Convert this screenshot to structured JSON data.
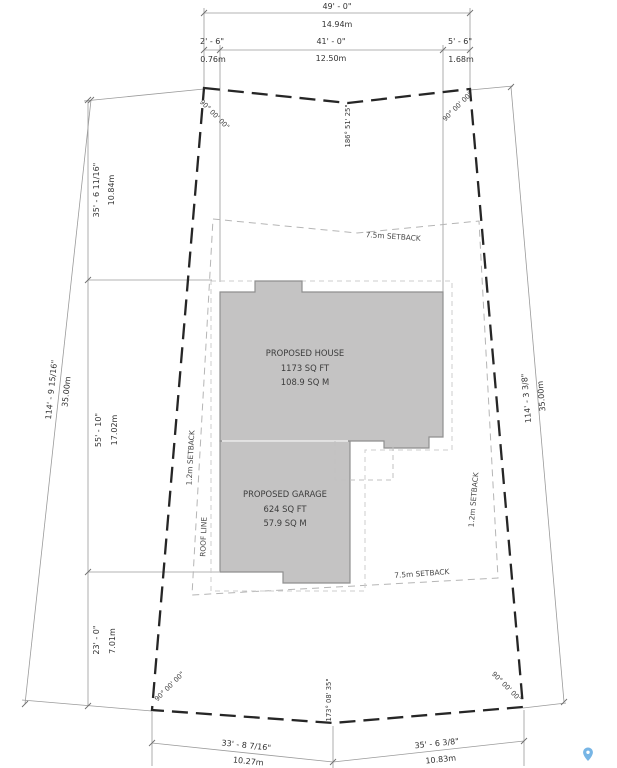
{
  "colors": {
    "lot_boundary": "#262626",
    "building_fill": "#c4c3c3",
    "building_stroke": "#8f8f8f",
    "dimension_line": "#9a9a9a",
    "setback_line": "#b5b5b5",
    "roof_line_dash": "#cccccc",
    "text": "#333333",
    "pin_blue": "#77b5e5"
  },
  "labels": {
    "house": {
      "name": "PROPOSED HOUSE",
      "area_ft": "1173 SQ FT",
      "area_m": "108.9 SQ M"
    },
    "garage": {
      "name": "PROPOSED GARAGE",
      "area_ft": "624 SQ FT",
      "area_m": "57.9 SQ M"
    },
    "setback_front": "7.5m SETBACK",
    "setback_rear": "7.5m SETBACK",
    "setback_left": "1.2m SETBACK",
    "setback_right": "1.2m SETBACK",
    "roof_line": "ROOF LINE"
  },
  "dimensions": {
    "top": {
      "overall_ft": "49' - 0\"",
      "overall_m": "14.94m",
      "seg_left_ft": "2' - 6\"",
      "seg_left_m": "0.76m",
      "seg_mid_ft": "41' - 0\"",
      "seg_mid_m": "12.50m",
      "seg_right_ft": "5' - 6\"",
      "seg_right_m": "1.68m"
    },
    "left": {
      "overall_ft": "114' - 9 15/16\"",
      "overall_m": "35.00m",
      "seg_upper_ft": "35' - 6 11/16\"",
      "seg_upper_m": "10.84m",
      "seg_mid_ft": "55' - 10\"",
      "seg_mid_m": "17.02m",
      "seg_lower_ft": "23' - 0\"",
      "seg_lower_m": "7.01m"
    },
    "right": {
      "overall_ft": "114' - 3 3/8\"",
      "overall_m": "35.00m"
    },
    "bottom": {
      "seg_left_ft": "33' - 8 7/16\"",
      "seg_left_m": "10.27m",
      "seg_right_ft": "35' - 6 3/8\"",
      "seg_right_m": "10.83m"
    }
  },
  "angles": {
    "top_left": "90° 00' 00\"",
    "top_middle": "186° 51' 25\"",
    "top_right": "90° 00' 00\"",
    "bottom_left": "90° 00' 00\"",
    "bottom_middle": "173° 08' 35\"",
    "bottom_right": "90° 00' 00\""
  },
  "icons": {
    "map_pin": "location-pin"
  }
}
